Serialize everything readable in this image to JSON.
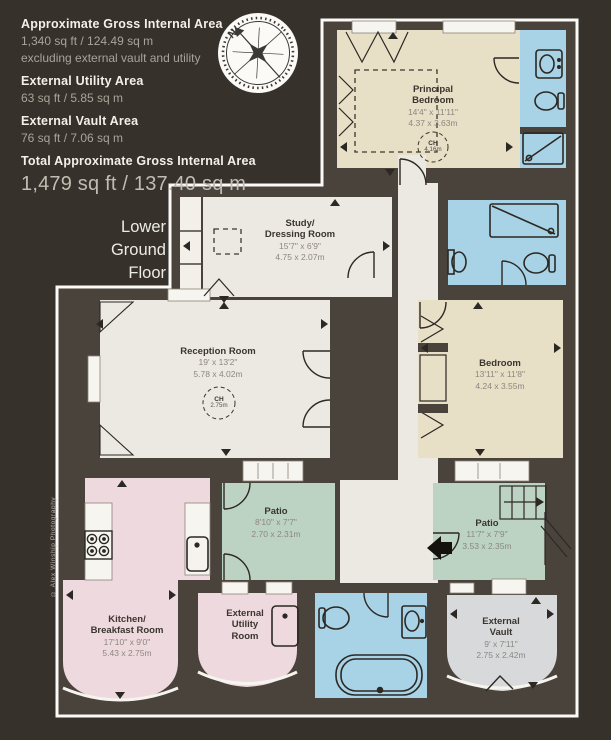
{
  "header": {
    "gia_label": "Approximate Gross Internal Area",
    "gia_value": "1,340 sq ft / 124.49 sq m",
    "gia_note": "excluding external vault and utility",
    "utility_label": "External Utility Area",
    "utility_value": "63 sq ft / 5.85 sq m",
    "vault_label": "External Vault Area",
    "vault_value": "76 sq ft / 7.06 sq m",
    "total_label": "Total Approximate Gross Internal Area",
    "total_value": "1,479 sq ft / 137.40 sq m"
  },
  "floor_label": "Lower Ground Floor",
  "compass": {
    "north_label": "N"
  },
  "copyright_note": "© Alex Winship Photography",
  "rooms": {
    "principal_bedroom": {
      "name": "Principal\nBedroom",
      "imperial": "14'4\" x 11'11\"",
      "metric": "4.37 x 3.63m",
      "ch_label": "CH",
      "ch_value": "4.16m"
    },
    "study_dressing": {
      "name": "Study/\nDressing Room",
      "imperial": "15'7\" x 6'9\"",
      "metric": "4.75 x 2.07m"
    },
    "reception": {
      "name": "Reception Room",
      "imperial": "19' x 13'2\"",
      "metric": "5.78 x 4.02m",
      "ch_label": "CH",
      "ch_value": "2.75m"
    },
    "bedroom": {
      "name": "Bedroom",
      "imperial": "13'11\" x 11'8\"",
      "metric": "4.24 x 3.55m"
    },
    "kitchen": {
      "name": "Kitchen/\nBreakfast Room",
      "imperial": "17'10\" x 9'0\"",
      "metric": "5.43 x 2.75m"
    },
    "patio_left": {
      "name": "Patio",
      "imperial": "8'10\" x 7'7\"",
      "metric": "2.70 x 2.31m"
    },
    "patio_right": {
      "name": "Patio",
      "imperial": "11'7\" x 7'9\"",
      "metric": "3.53 x 2.35m"
    },
    "external_utility": {
      "name": "External\nUtility\nRoom"
    },
    "external_vault": {
      "name": "External\nVault",
      "imperial": "9' x 7'11\"",
      "metric": "2.75 x 2.42m"
    }
  },
  "colors": {
    "background": "#37312b",
    "wall": "#4a433b",
    "plan_border": "#fbfaf7",
    "bedroom_fill": "#e8dfc7",
    "bathroom_fill": "#a8d2e5",
    "living_fill": "#ebe9e2",
    "kitchen_fill": "#eed9de",
    "patio_fill": "#bcd3c4",
    "vault_fill": "#d8d9db"
  }
}
